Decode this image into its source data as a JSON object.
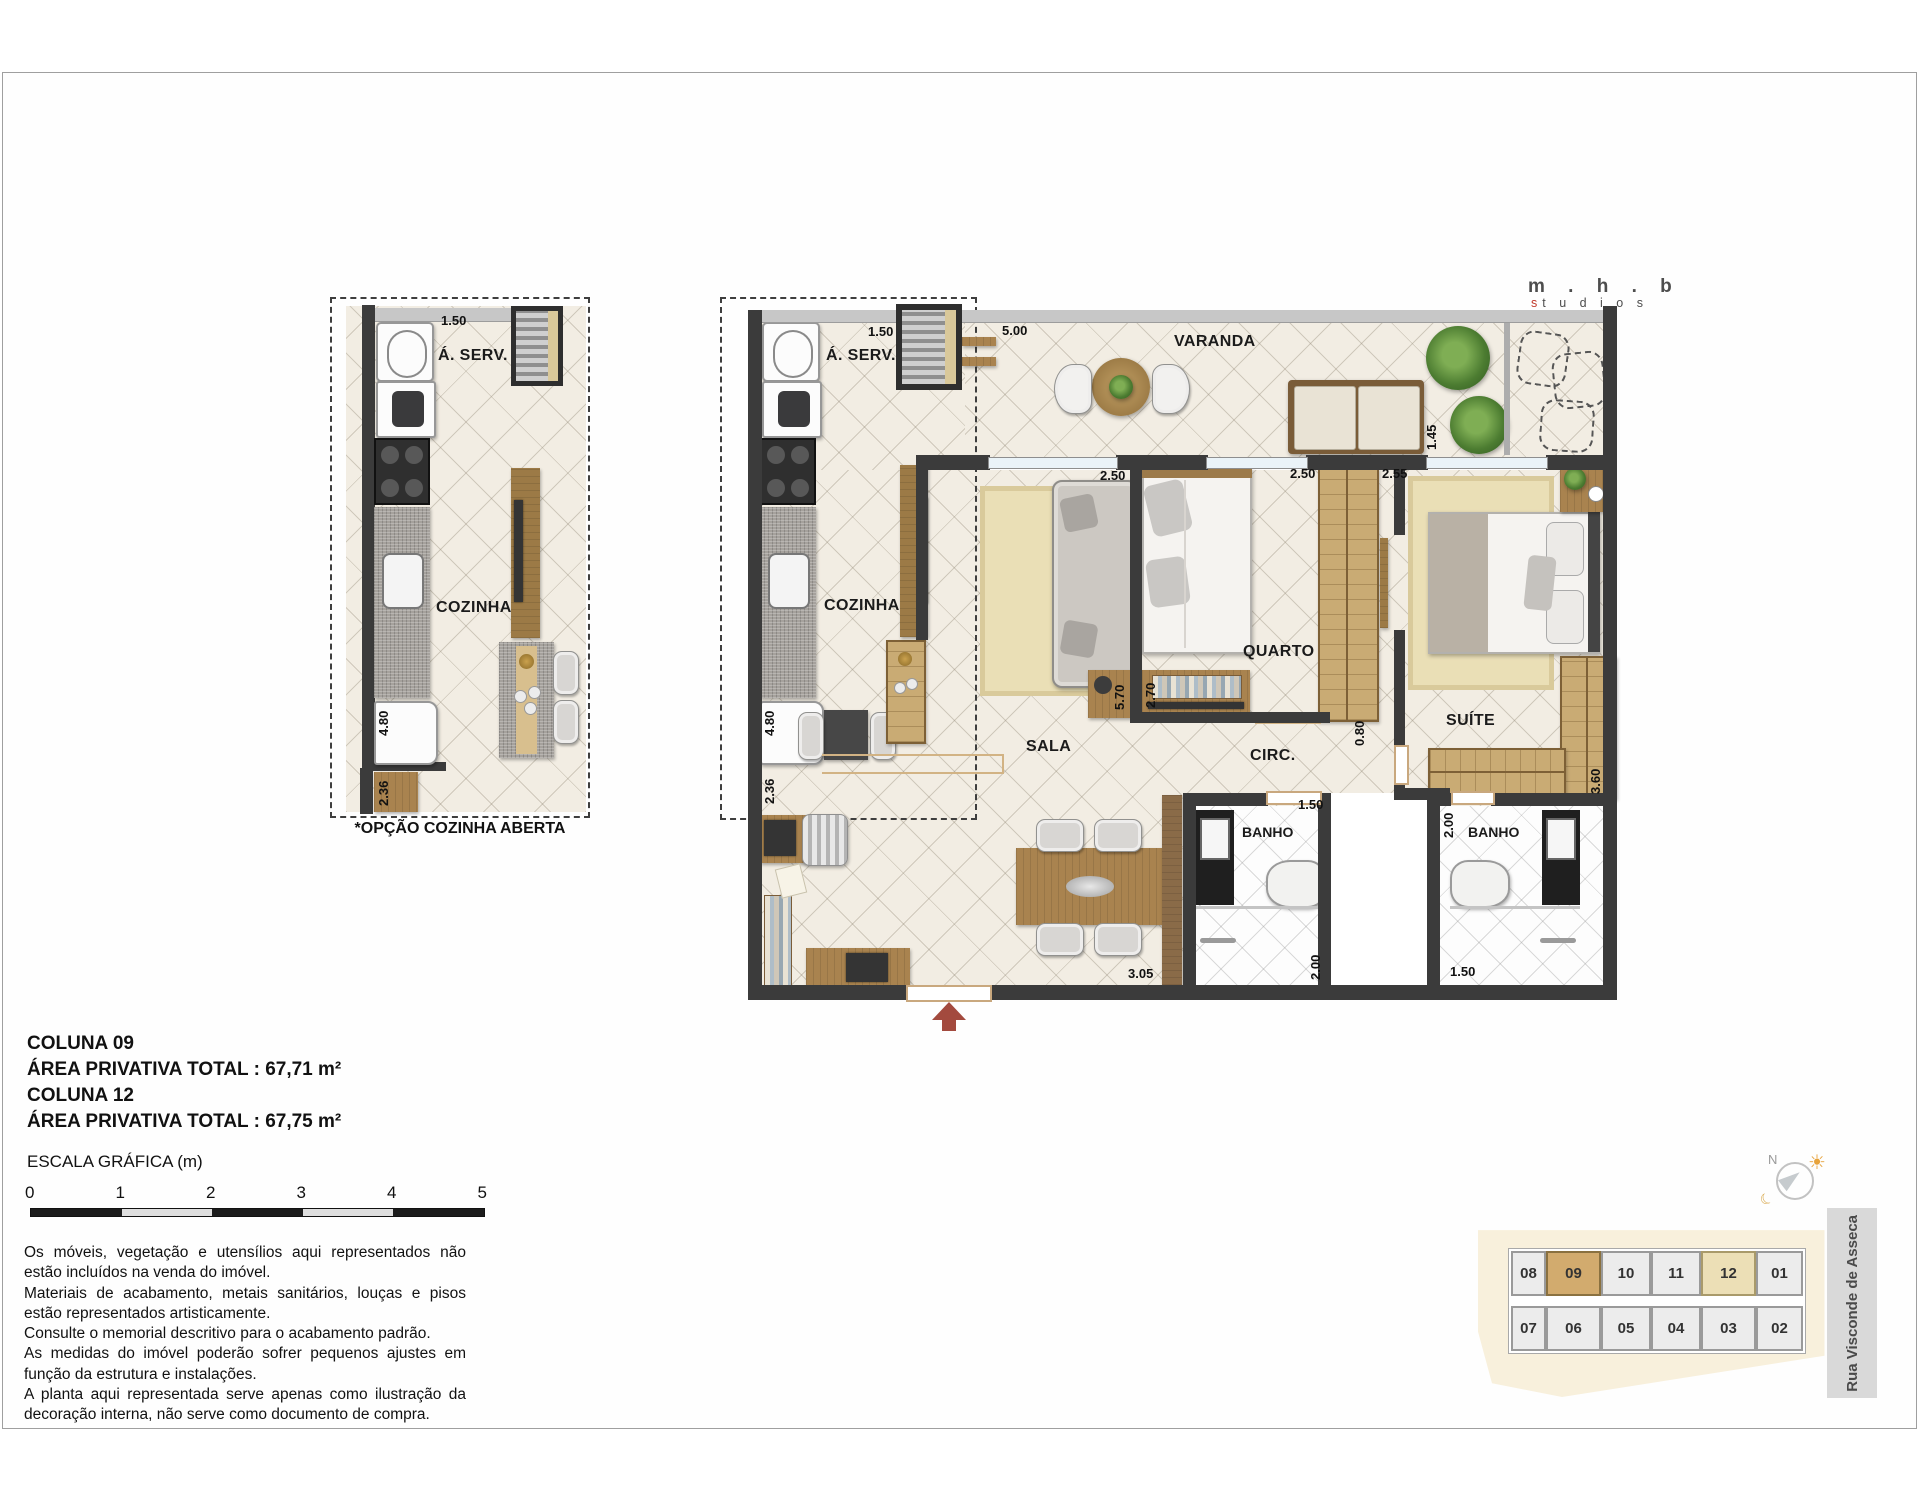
{
  "logo": {
    "line1": "m . h . b",
    "sub_s": "s",
    "sub_rest": "t u d i o s",
    "accent": "#c0392b"
  },
  "option_plan": {
    "caption": "*OPÇÃO COZINHA ABERTA",
    "labels": {
      "aserv": "Á. SERV.",
      "cozinha": "COZINHA"
    },
    "dims": {
      "top": "1.50",
      "counter": "4.80",
      "entry": "2.36"
    }
  },
  "main_plan": {
    "labels": {
      "aserv": "Á. SERV.",
      "cozinha": "COZINHA",
      "varanda": "VARANDA",
      "sala": "SALA",
      "quarto": "QUARTO",
      "circ": "CIRC.",
      "suite": "SUÍTE",
      "banho1": "BANHO",
      "banho2": "BANHO"
    },
    "dims": {
      "aserv_top": "1.50",
      "varanda_top": "5.00",
      "varanda_right": "1.45",
      "sala_window": "2.50",
      "quarto_window": "2.50",
      "suite_window": "2.55",
      "sala_side": "5.70",
      "quarto_side": "2.70",
      "circ": "0.80",
      "suite_closet": "3.60",
      "kitchen_counter": "4.80",
      "office": "2.36",
      "sala_bottom": "3.05",
      "banho1_width": "1.50",
      "banho1_depth": "2.00",
      "banho2_depth": "2.00",
      "banho2_width": "1.50"
    }
  },
  "info": {
    "col09_title": "COLUNA 09",
    "col09_area": "ÁREA PRIVATIVA TOTAL :  67,71 m²",
    "col12_title": "COLUNA 12",
    "col12_area": "ÁREA PRIVATIVA TOTAL :  67,75 m²"
  },
  "scale_bar": {
    "title": "ESCALA GRÁFICA (m)",
    "ticks": [
      "0",
      "1",
      "2",
      "3",
      "4",
      "5"
    ]
  },
  "disclaimer": {
    "p1": "Os móveis, vegetação e utensílios aqui representados não estão incluídos na venda do imóvel.",
    "p2": "Materiais de acabamento, metais sanitários, louças e pisos estão representados artisticamente.",
    "p3": "Consulte o memorial descritivo para o acabamento padrão.",
    "p4": "As medidas do imóvel poderão sofrer pequenos ajustes em função da estrutura e instalações.",
    "p5": "A planta aqui representada serve apenas como ilustração da decoração interna, não serve como documento de compra."
  },
  "keyplan": {
    "street": "Rua Visconde de Asseca",
    "compass_north": "N",
    "units_top": [
      "08",
      "09",
      "10",
      "11",
      "12",
      "01"
    ],
    "units_bottom": [
      "07",
      "06",
      "05",
      "04",
      "03",
      "02"
    ],
    "highlight_primary": "09",
    "highlight_primary_color": "#d2ab6e",
    "highlight_secondary": "12",
    "highlight_secondary_color": "#ecdfb6"
  }
}
